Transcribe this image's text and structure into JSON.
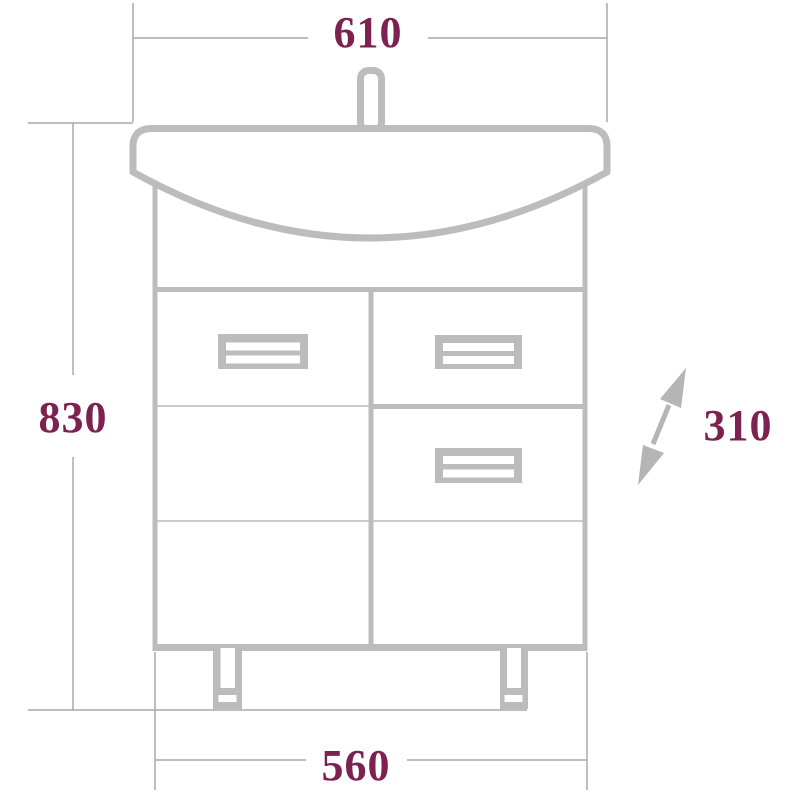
{
  "drawing": {
    "type": "technical-drawing",
    "dimensions": {
      "top_width": "610",
      "left_height": "830",
      "right_depth": "310",
      "bottom_width": "560"
    },
    "icons": {
      "depth_arrow": "diagonal-double-headed-arrow"
    },
    "colors": {
      "dimension_text": "#7d2150",
      "furniture_line": "#bcbcbc",
      "dimension_line": "#a9a9a9",
      "background": "#ffffff"
    }
  }
}
